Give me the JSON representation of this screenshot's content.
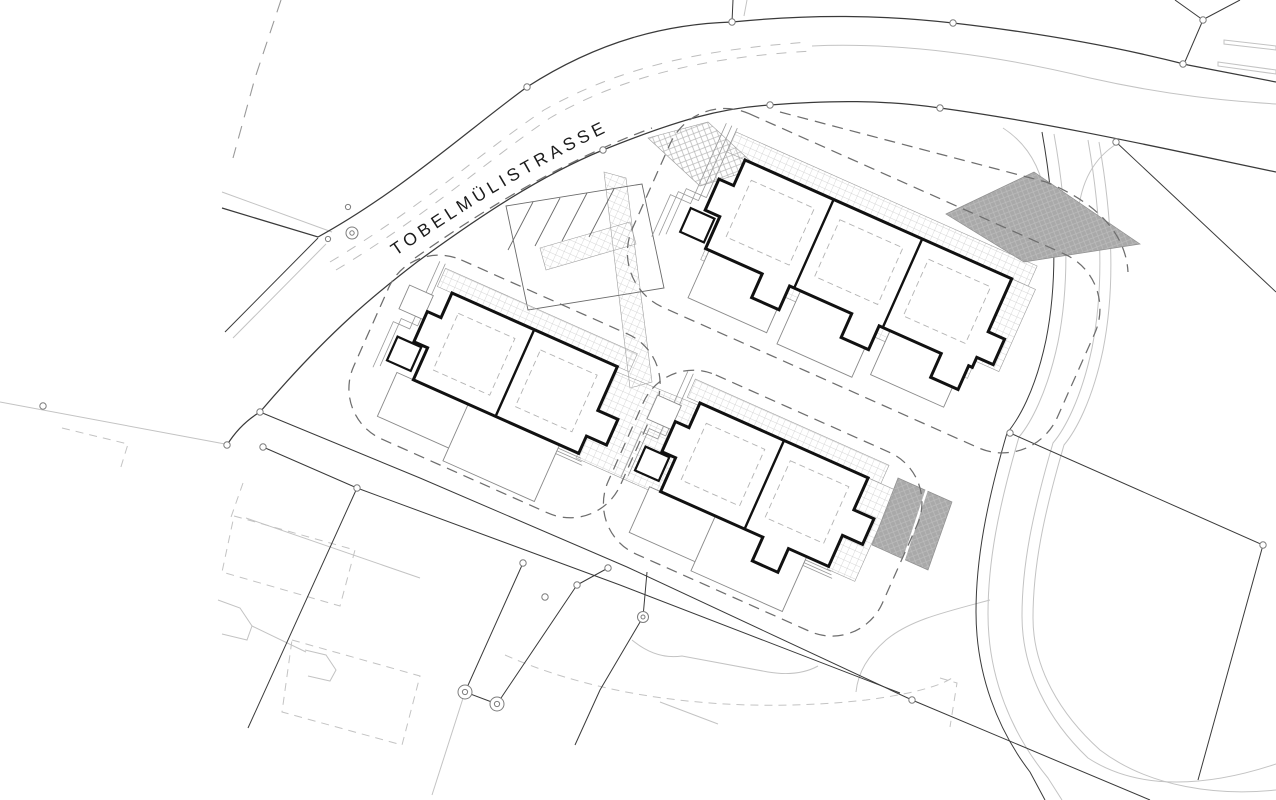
{
  "road": {
    "label": "TOBELMÜLISTRASSE"
  },
  "site": {
    "buildings": [
      {
        "id": "west",
        "units": 2
      },
      {
        "id": "north",
        "units": 3
      },
      {
        "id": "south",
        "units": 2
      }
    ],
    "parking": {
      "stall_dividers": 4,
      "gray_lots": 2
    }
  },
  "colors": {
    "line_dark": "#3a3a3a",
    "line_medium": "#6a6a6a",
    "line_light": "#c3c3c3",
    "hatch_line": "#c9c9c9",
    "parking_fill": "#a9a9a9",
    "parking_hatch": "#bdbdbd",
    "building_stroke": "#111111",
    "building_fill": "#ffffff",
    "envelope": "#6e6e6e",
    "text": "#1c1c1c",
    "background": "#ffffff"
  }
}
